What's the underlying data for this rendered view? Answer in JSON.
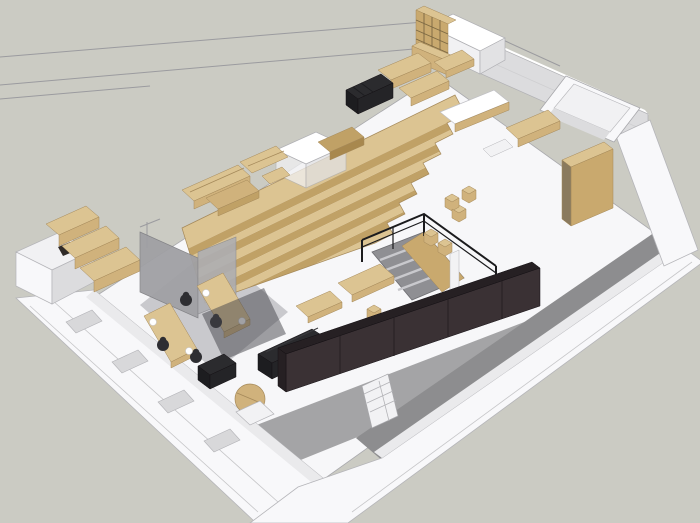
{
  "scene": {
    "title": "Axonometric 3D model of an office interior with tiered wooden seating",
    "view": "overhead axonometric, walls cut / rendered as wireframe on upper-left",
    "style": "SketchUp-like shaded render, no visible text"
  },
  "inventory": [
    "tiered wooden amphitheater seating",
    "stairwell opening with black railing and wood flank",
    "glass-walled office with two wooden desks, four black task chairs, white desk lamps",
    "L-shaped slatted lounge benches with low wood table",
    "white meeting booth cube",
    "wooden grid bookshelf and low cabinet",
    "white elevator core cube",
    "black slatted daybed",
    "wooden work tables and white-top table",
    "wooden cube stools",
    "dining tables with stools",
    "dark sofa, dark armchair, round wooden coffee table",
    "white cubby shelf",
    "long dark service counter",
    "tall wooden wardrobe",
    "gray terrace walkway along lower-right wall",
    "white perimeter walls with window recesses"
  ],
  "palette": {
    "background": "#cbcbc3",
    "floor": "#f7f7f9",
    "floor_office": "#c9c9cd",
    "floor_corridor": "#a4a4a6",
    "floor_terrace": "#8d8d8f",
    "wall_white": "#f8f8fa",
    "wall_top": "#ffffff",
    "wall_bright": "#f1f1f3",
    "wall_mid": "#e2e2e4",
    "wall_sheen": "#eaeaec",
    "wall_face": "#dcdcde",
    "window_gray": "#d8d8da",
    "wireframe": "#9b9b9f",
    "wood_light": "#dcc492",
    "wood_mid": "#d0b27c",
    "wood_dark": "#c0a166",
    "wood_deep": "#a8884e",
    "wood_face": "#c9a96e",
    "wood_shadow": "#8a7a5e",
    "glass_gray": "#a0a0a4",
    "glass_gray2": "#aeaeb2",
    "glass_dark": "#44444a",
    "black_top": "#2b2b2e",
    "black_side": "#1d1d20",
    "black_side2": "#242427",
    "counter": "#3a3134",
    "counter_top": "#262023",
    "railing": "#1b1b1d",
    "stair_well": "#8f8f93",
    "stair_tread": "#c9c9cd",
    "chair": "#2e2e32",
    "lamp": "#ffffff",
    "shelf_white": "#f2f2f4",
    "slot_dark": "#2f2a28"
  }
}
